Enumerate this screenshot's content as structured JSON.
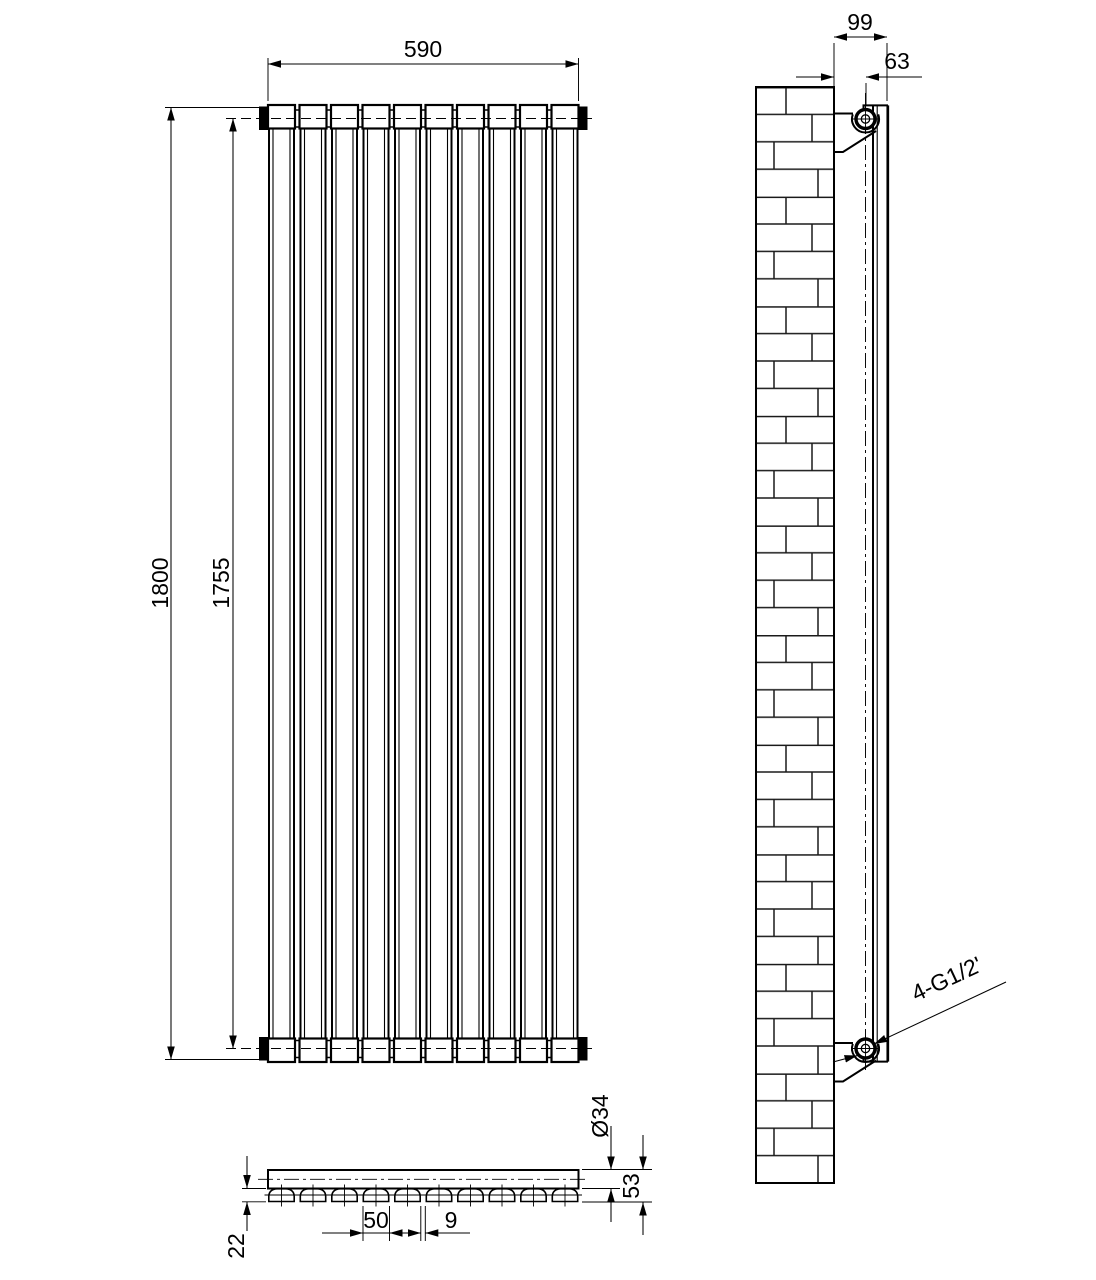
{
  "drawing": {
    "type": "radiator-technical-drawing",
    "front_view": {
      "width_label": "590",
      "height_label": "1800",
      "inner_height_label": "1755",
      "panel_count": 10
    },
    "side_view": {
      "wall_to_front_label": "99",
      "wall_to_pipe_center_label": "63",
      "connections_label": "4-G1/2'"
    },
    "section_view": {
      "tube_width_label": "50",
      "tube_gap_label": "9",
      "header_diameter_label": "Ø34",
      "total_depth_label": "53",
      "tube_depth_label": "22"
    },
    "colors": {
      "line": "#000000",
      "background": "#ffffff"
    }
  }
}
